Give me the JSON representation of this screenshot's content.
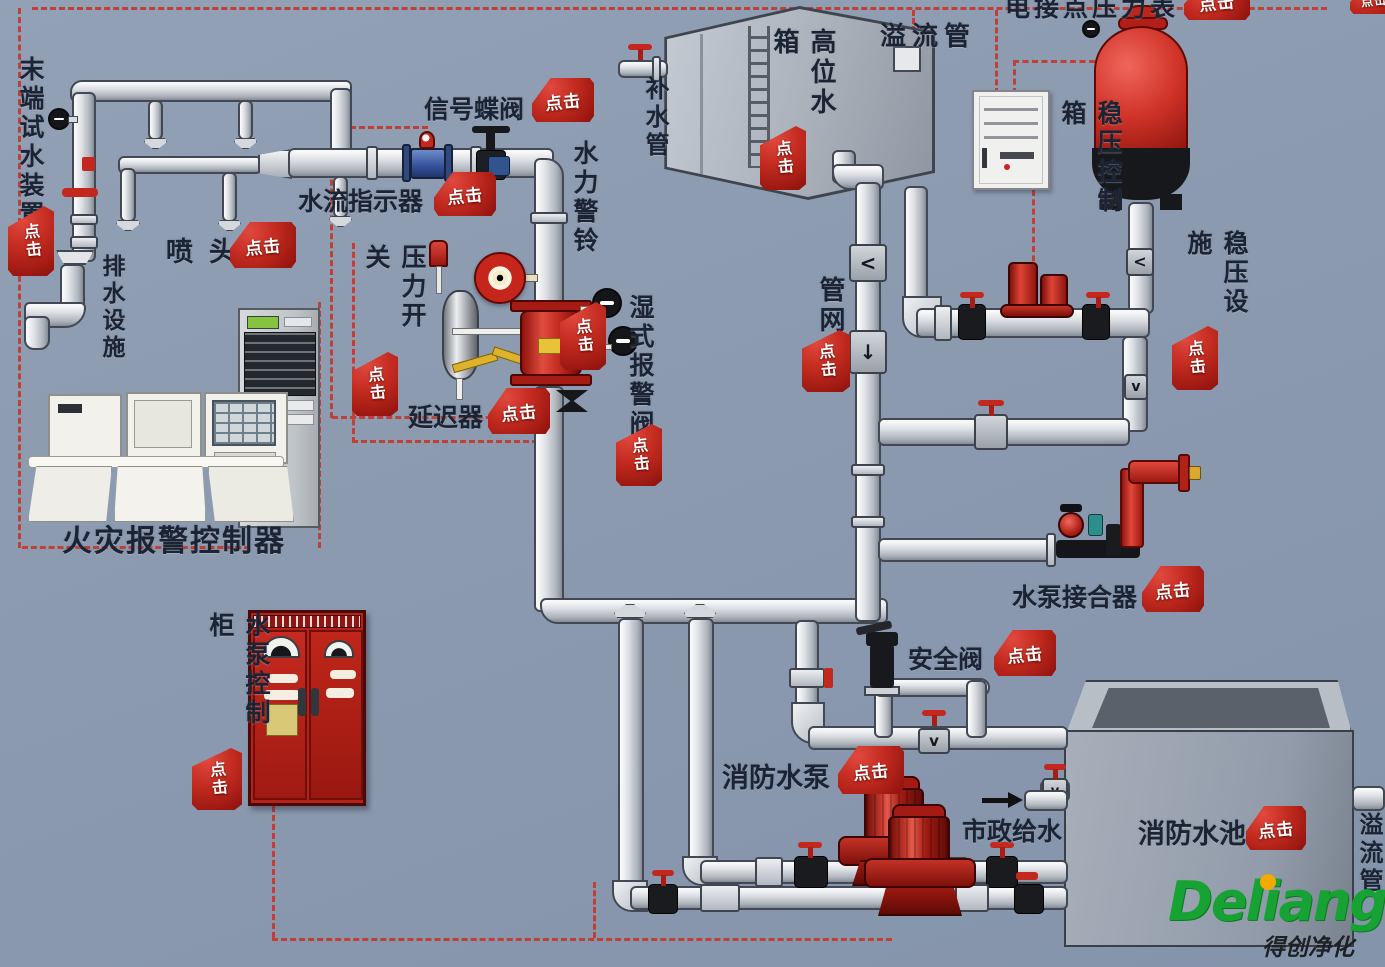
{
  "ui": {
    "click": "点击",
    "flow_left": "<",
    "flow_down": "↓",
    "flow_check": "v"
  },
  "labels": {
    "end_test_device": "末端试水装置",
    "drain_facility": "排水设施",
    "sprinkler": "喷头",
    "flow_indicator": "水流指示器",
    "signal_butterfly_valve": "信号蝶阀",
    "hydraulic_alarm_bell": "水力警铃",
    "pressure_switch": "压力开关",
    "delayer": "延迟器",
    "wet_alarm_valve": "湿式报警阀",
    "high_level_tank": "高位水箱",
    "refill_pipe": "补水管",
    "overflow_pipe_top": "溢流管",
    "electric_contact_gauge": "电接点压力表",
    "stabilizer_control_box": "稳压控制箱",
    "stabilizer_facility": "稳压设施",
    "pipe_network": "管网",
    "pump_adapter": "水泵接合器",
    "safety_valve": "安全阀",
    "fire_pump": "消防水泵",
    "city_water_supply": "市政给水",
    "fire_pool": "消防水池",
    "overflow_pipe_right": "溢流管",
    "fire_alarm_controller": "火灾报警控制器",
    "pump_control_cabinet": "水泵控制柜"
  },
  "logo": {
    "brand": "Deliang",
    "subtext": "得创净化"
  },
  "colors": {
    "background": "#8c9ab0",
    "click_red": "#b8211c",
    "tank_red": "#c5271e",
    "logo_green": "#17a333"
  }
}
